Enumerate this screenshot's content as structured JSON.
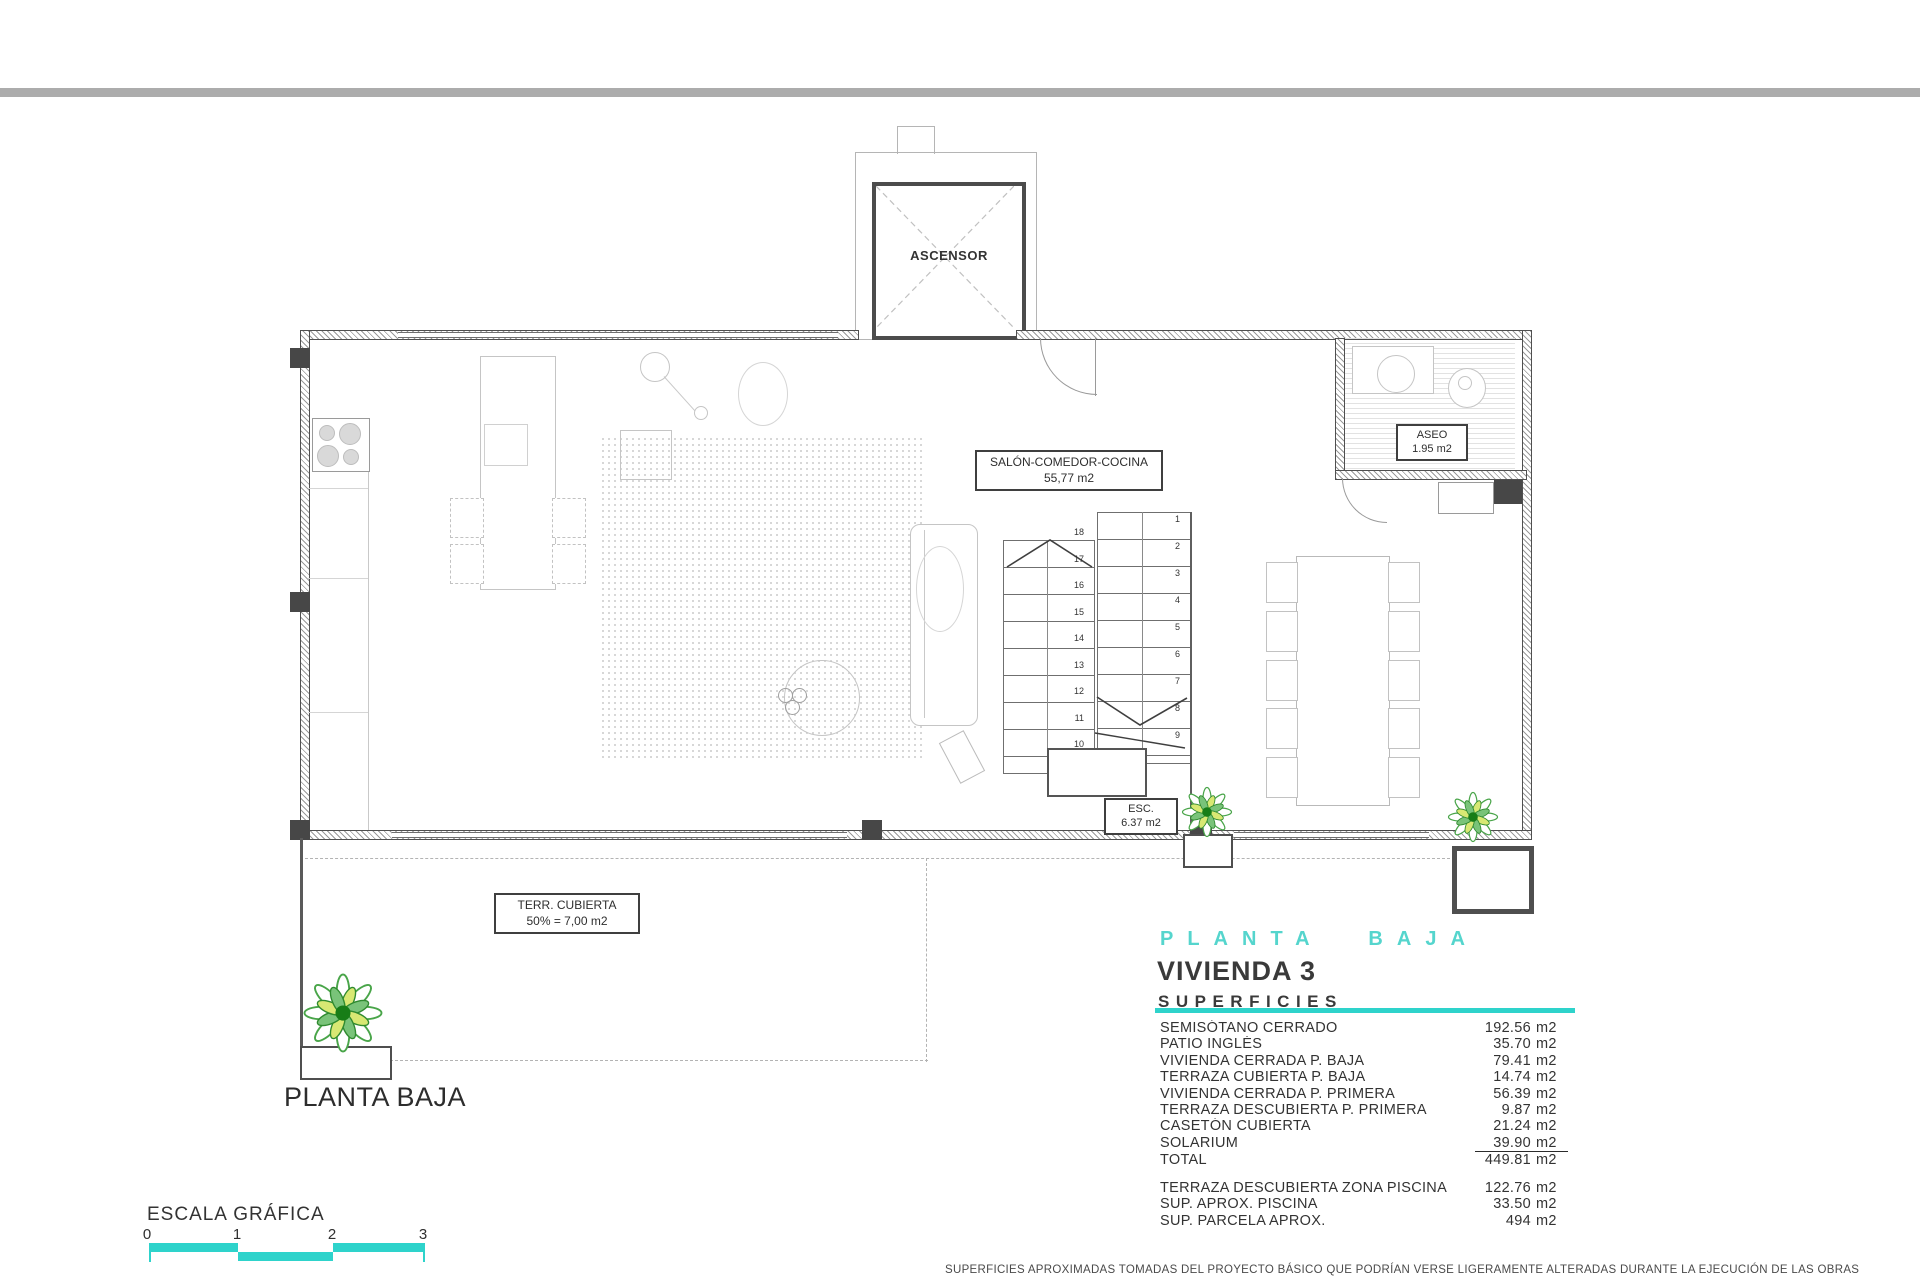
{
  "colors": {
    "accent": "#2ed3cb",
    "top_bar": "#acacac"
  },
  "plan": {
    "elevator_label": "ASCENSOR",
    "salon_label": {
      "line1": "SALÓN-COMEDOR-COCINA",
      "line2": "55,77 m2"
    },
    "aseo_label": {
      "line1": "ASEO",
      "line2": "1.95 m2"
    },
    "esc_label": {
      "line1": "ESC.",
      "line2": "6.37 m2"
    },
    "terraza_label": {
      "line1": "TERR. CUBIERTA",
      "line2": "50% = 7,00 m2"
    },
    "floor_caption": "PLANTA BAJA",
    "stair_numbers_right": [
      "1",
      "2",
      "3",
      "4",
      "5",
      "6",
      "7",
      "8",
      "9"
    ],
    "stair_numbers_left": [
      "18",
      "17",
      "16",
      "15",
      "14",
      "13",
      "12",
      "11",
      "10"
    ]
  },
  "summary": {
    "floor_title": "PLANTA BAJA",
    "unit_title": "VIVIENDA 3",
    "section_title": "SUPERFICIES",
    "rows": [
      {
        "label": "SEMISÓTANO CERRADO",
        "value": "192.56",
        "unit": "m2"
      },
      {
        "label": "PATIO INGLÉS",
        "value": "35.70",
        "unit": "m2"
      },
      {
        "label": "VIVIENDA CERRADA P. BAJA",
        "value": "79.41",
        "unit": "m2"
      },
      {
        "label": "TERRAZA CUBIERTA P. BAJA",
        "value": "14.74",
        "unit": "m2"
      },
      {
        "label": "VIVIENDA CERRADA P. PRIMERA",
        "value": "56.39",
        "unit": "m2"
      },
      {
        "label": "TERRAZA DESCUBIERTA P. PRIMERA",
        "value": "9.87",
        "unit": "m2"
      },
      {
        "label": "CASETÓN CUBIERTA",
        "value": "21.24",
        "unit": "m2"
      },
      {
        "label": "SOLARIUM",
        "value": "39.90",
        "unit": "m2",
        "underline": true
      },
      {
        "label": "TOTAL",
        "value": "449.81",
        "unit": "m2"
      }
    ],
    "extra_rows": [
      {
        "label": "TERRAZA DESCUBIERTA  ZONA PISCINA",
        "value": "122.76",
        "unit": "m2"
      },
      {
        "label": "SUP.  APROX.  PISCINA",
        "value": "33.50",
        "unit": "m2"
      },
      {
        "label": "SUP. PARCELA APROX.",
        "value": "494",
        "unit": "m2"
      }
    ]
  },
  "scale": {
    "title": "ESCALA GRÁFICA",
    "ticks": [
      "0",
      "1",
      "2",
      "3"
    ]
  },
  "footer": {
    "disclaimer": "SUPERFICIES APROXIMADAS TOMADAS DEL PROYECTO BÁSICO QUE PODRÍAN VERSE LIGERAMENTE ALTERADAS DURANTE LA EJECUCIÓN DE LAS OBRAS"
  }
}
